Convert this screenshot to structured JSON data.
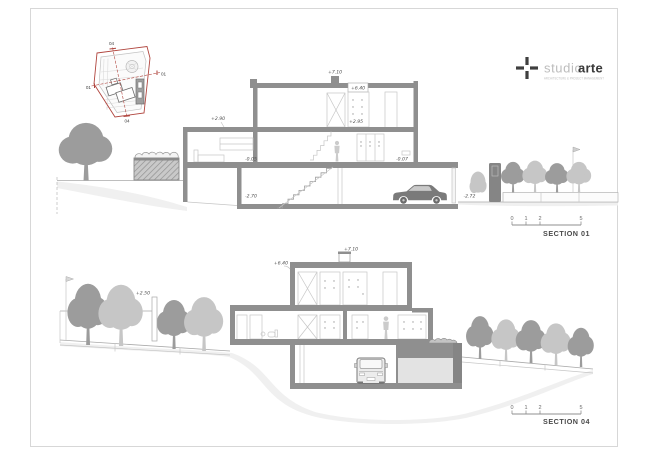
{
  "sheet": {
    "background": "#ffffff",
    "border_color": "#d7d7d7"
  },
  "logo": {
    "name_light": "studio",
    "name_bold": "arte",
    "subtitle": "ARCHITECTURE & PROJECT MANAGEMENT",
    "cross_icon_color": "#3f3f3f"
  },
  "site_plan": {
    "boundary_color": "#b0453e",
    "label_top": "04",
    "label_bottom": "04",
    "label_left": "01",
    "label_right": "01"
  },
  "section01": {
    "title": "SECTION 01",
    "levels": {
      "chimney_top": "+7.10",
      "roof": "+6.40",
      "upper_slab": "+2.90",
      "upper_floor": "+2.95",
      "ground_floor": "-0.05",
      "entrance": "-0.07",
      "garage_floor": "-2.70",
      "driveway": "-2.72"
    },
    "scale_marks": {
      "m0": "0",
      "m1": "1",
      "m2": "2",
      "m5": "5"
    }
  },
  "section04": {
    "title": "SECTION 04",
    "levels": {
      "chimney_top": "+7.10",
      "roof": "+6.40",
      "street": "+2.50"
    },
    "scale_marks": {
      "m0": "0",
      "m1": "1",
      "m2": "2",
      "m5": "5"
    }
  },
  "palette": {
    "wall": "#8f8f8f",
    "tree_dark": "#9c9c9c",
    "tree_light": "#c6c6c6",
    "terrain": "#f0f0f0",
    "car": "#7a7a7a",
    "text": "#4d4d4d"
  }
}
